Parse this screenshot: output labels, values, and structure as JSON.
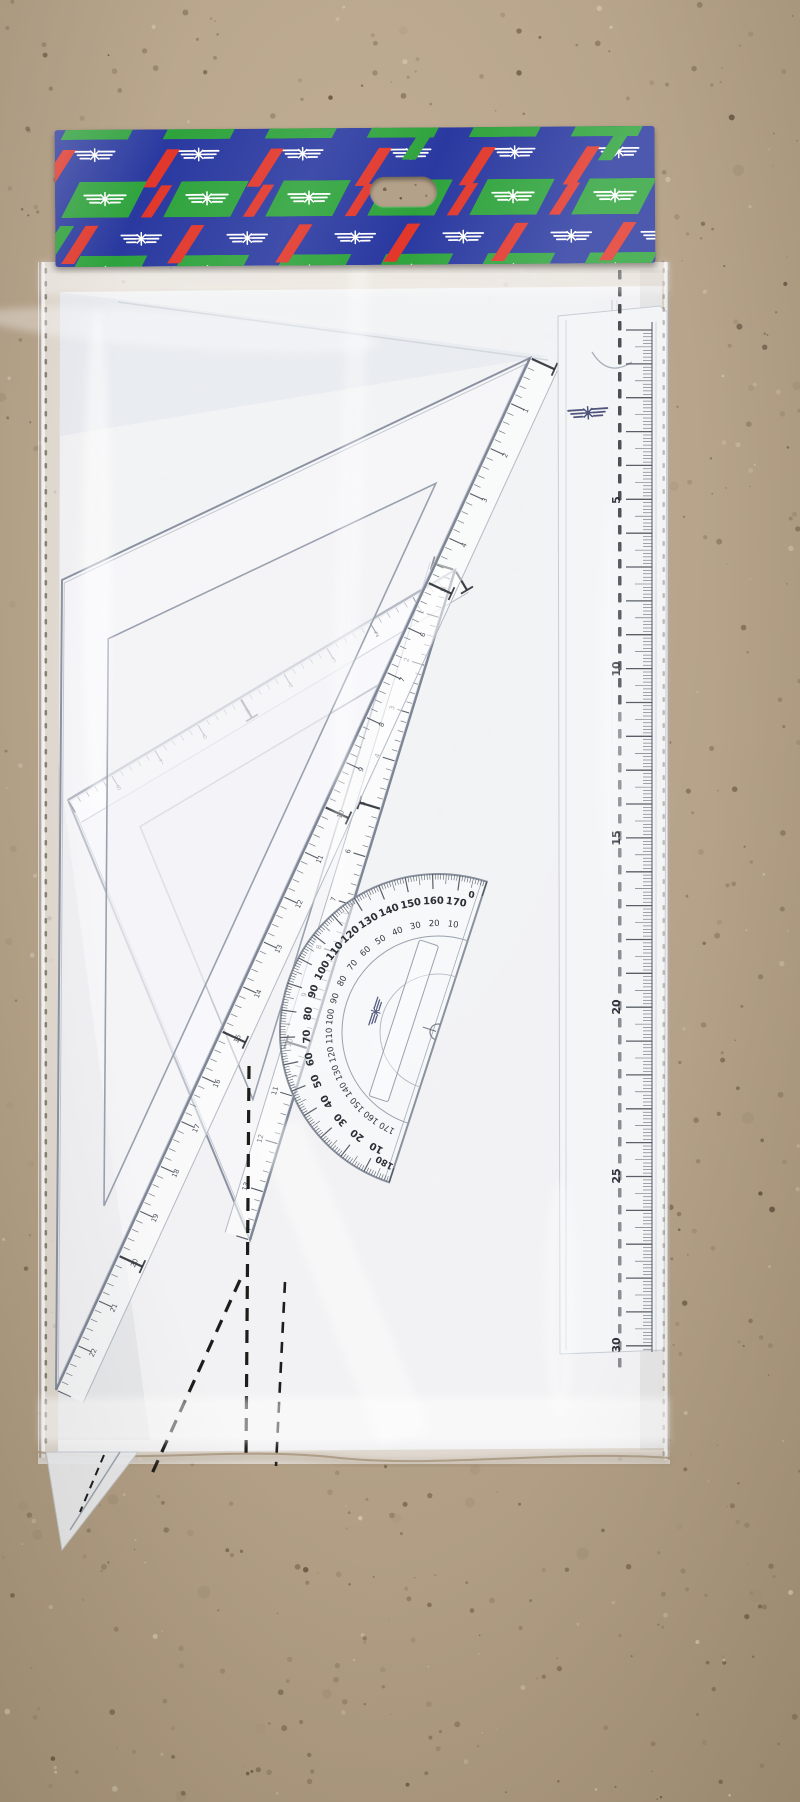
{
  "photo": {
    "subject": "geometry-set in clear plastic package hanging on cork board"
  },
  "colors": {
    "cork_base": "#b6a38a",
    "cork_dark": "#77644d",
    "cork_mid": "#94816a",
    "cork_deep": "#5f4f3c",
    "cork_light": "#d2c5b0",
    "card_blue": "#2a39a0",
    "card_red": "#e2372b",
    "card_green": "#2ea33c",
    "logo_white": "#ffffff",
    "logo_navy": "#333a66",
    "paper": "#f2f3f6",
    "plastic_edge": "#c9ced6",
    "ink": "#3a3f48",
    "tick_dark": "#2e3238",
    "dash_black": "#1d1d1b"
  },
  "header_card": {
    "pattern_logo": "wing-star-logo",
    "badge_row_count": 6,
    "logo_rows": [
      6,
      6
    ],
    "hang_hole": "euro-slot"
  },
  "long_ruler": {
    "cm_labels": [
      "5",
      "10",
      "15",
      "20",
      "25",
      "30"
    ],
    "brand_logo": "wing-star-logo"
  },
  "triangle_large": {
    "scale_labels": [
      "1",
      "2",
      "3",
      "4",
      "5",
      "6",
      "7",
      "8",
      "9",
      "10",
      "11",
      "12",
      "13",
      "14",
      "15",
      "16",
      "17",
      "18",
      "19",
      "20",
      "21",
      "22"
    ]
  },
  "triangle_medium": {
    "band1_labels": [
      "1",
      "2",
      "3",
      "4",
      "5",
      "6",
      "7",
      "8"
    ],
    "band2_labels": [
      "1",
      "2",
      "3",
      "4",
      "5",
      "6",
      "7",
      "8",
      "9",
      "10",
      "11",
      "12",
      "13"
    ]
  },
  "protractor": {
    "outer_labels": [
      "170",
      "160",
      "150",
      "140",
      "130",
      "120",
      "110",
      "100",
      "90",
      "80",
      "70",
      "60",
      "50",
      "40",
      "30",
      "20",
      "10"
    ],
    "inner_labels": [
      "10",
      "20",
      "30",
      "40",
      "50",
      "60",
      "70",
      "80",
      "90",
      "100",
      "110",
      "120",
      "130",
      "140",
      "150",
      "160",
      "170"
    ],
    "end_labels": [
      "180",
      "0"
    ],
    "brand_logo": "wing-star-logo"
  }
}
